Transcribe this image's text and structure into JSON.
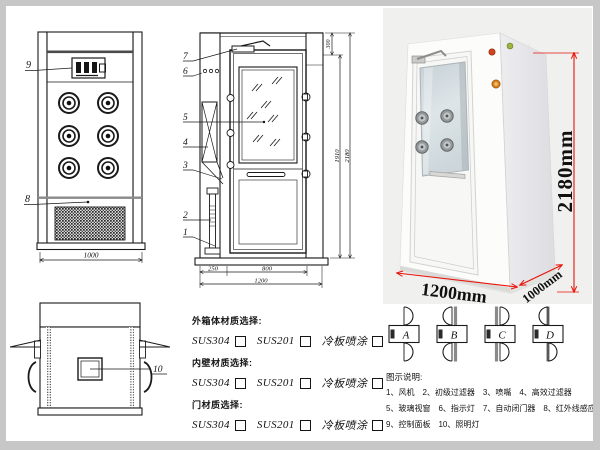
{
  "page": {
    "frame_color": "#c7c7c7",
    "line_color": "#1a1a1a",
    "accent_red": "#e81309",
    "photo_bg": "#f0f0ee"
  },
  "front_view": {
    "part_label_control_panel": "9",
    "part_label_grille": "8",
    "dim_width": "1000"
  },
  "side_view": {
    "part_labels": [
      "7",
      "6",
      "5",
      "4",
      "3",
      "2",
      "1"
    ],
    "dim_top": "300",
    "dim_inner_height": "1910",
    "dim_total_height": "2180",
    "dim_left_section": "250",
    "dim_door_width": "800",
    "dim_total_width": "1200"
  },
  "top_view": {
    "part_label_window": "10"
  },
  "photo": {
    "dim_height": "2180mm",
    "dim_width": "1200mm",
    "dim_depth": "1000mm"
  },
  "materials": {
    "groups": [
      {
        "title": "外箱体材质选择:",
        "options": [
          "SUS304",
          "SUS201",
          "冷板喷涂"
        ]
      },
      {
        "title": "内壁材质选择:",
        "options": [
          "SUS304",
          "SUS201",
          "冷板喷涂"
        ]
      },
      {
        "title": "门材质选择:",
        "options": [
          "SUS304",
          "SUS201",
          "冷板喷涂"
        ]
      }
    ]
  },
  "door_types": {
    "labels": [
      "A",
      "B",
      "C",
      "D"
    ],
    "variants": [
      {
        "top": "R",
        "bottom": "R",
        "bar": "none"
      },
      {
        "top": "L",
        "bottom": "L",
        "bar": "right"
      },
      {
        "top": "R",
        "bottom": "R",
        "bar": "left"
      },
      {
        "top": "L",
        "bottom": "R",
        "bar": "center"
      }
    ]
  },
  "legend": {
    "title": "图示说明:",
    "rows": [
      [
        "1、风机",
        "2、初级过滤器",
        "3、喷嘴",
        "4、高效过滤器"
      ],
      [
        "5、玻璃视窗",
        "6、指示灯",
        "7、自动闭门器",
        "8、红外线感应器"
      ],
      [
        "9、控制面板",
        "10、照明灯"
      ]
    ]
  }
}
